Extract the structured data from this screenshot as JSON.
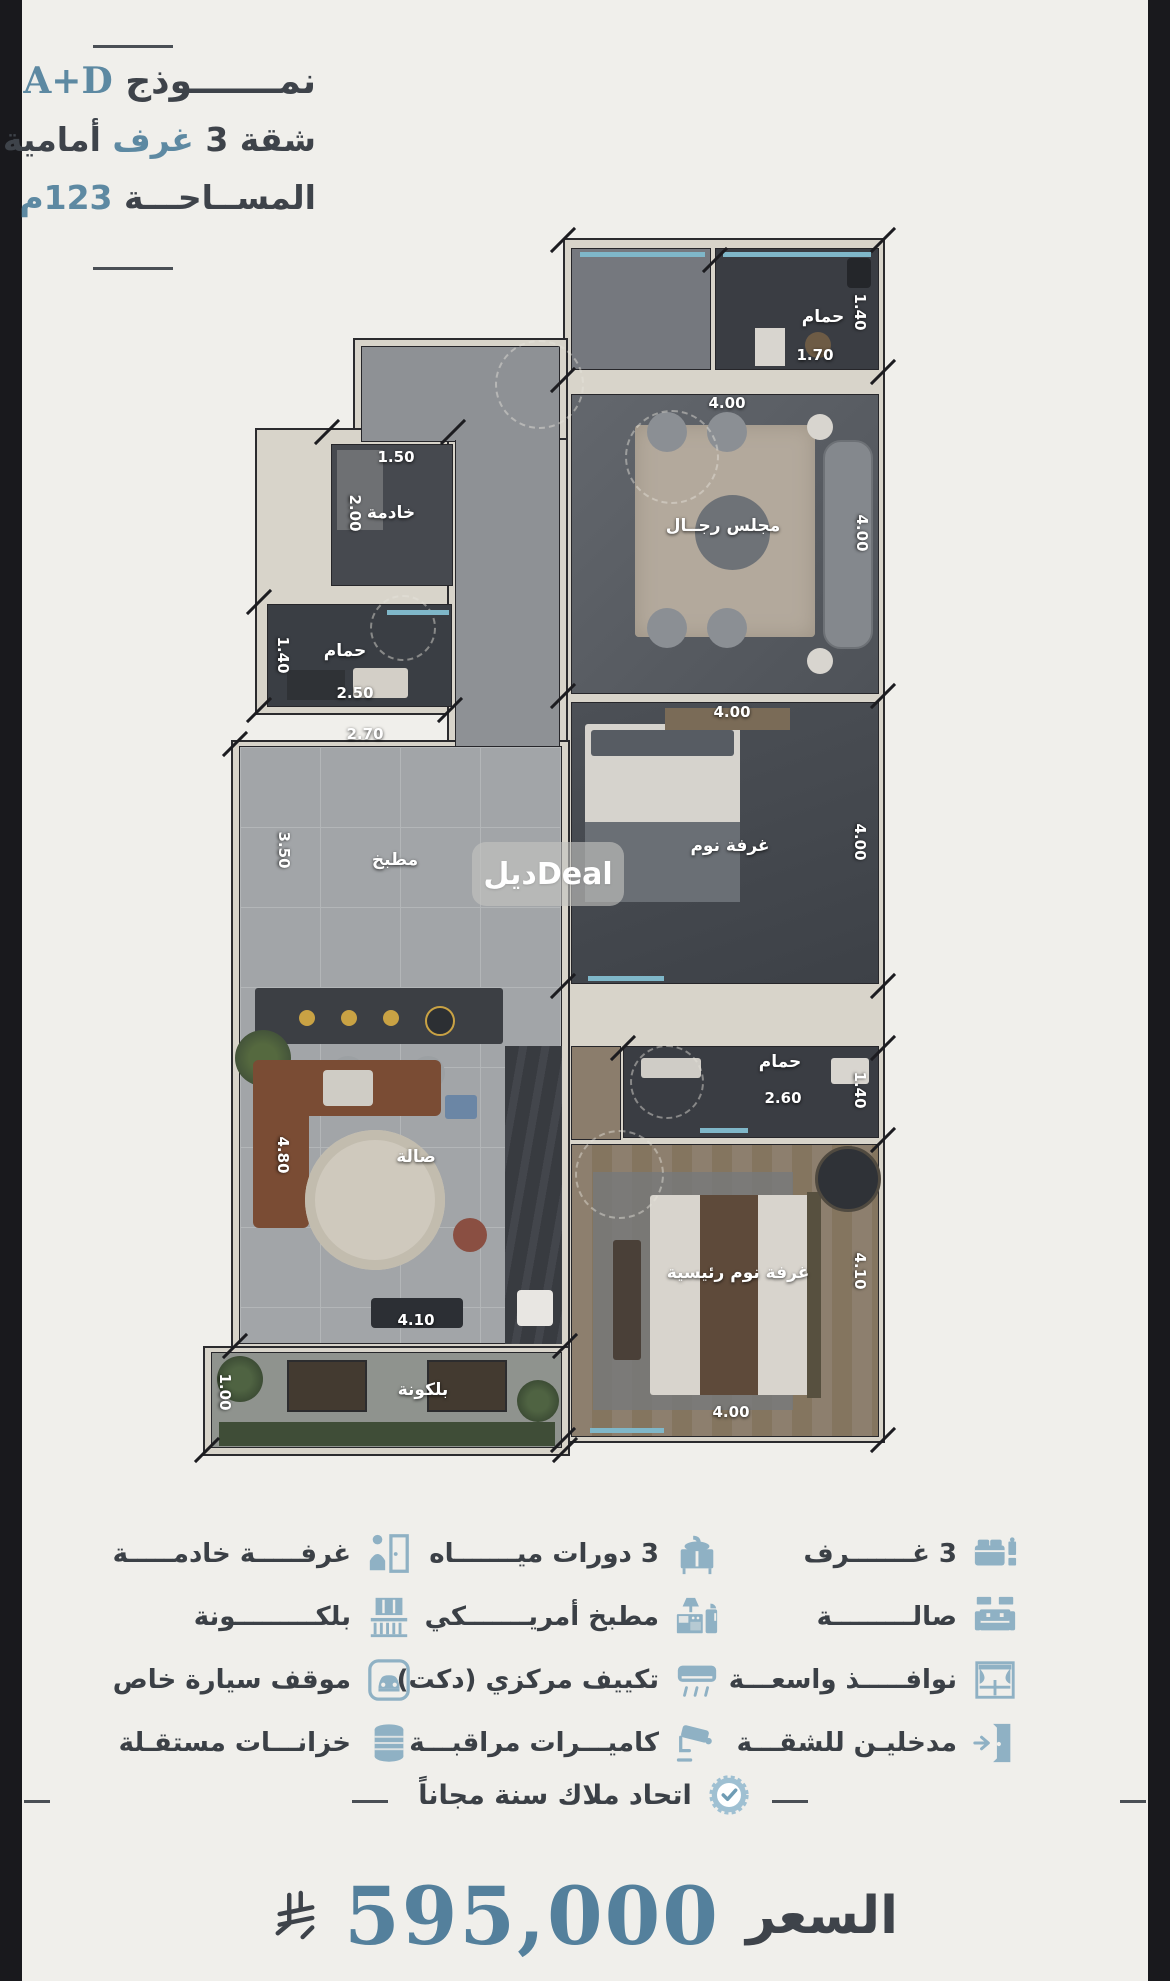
{
  "page": {
    "bg": "#f0efeb",
    "edge_strip_color": "#19191d",
    "accent_blue": "#5d89a2",
    "text_dark": "#3b4046",
    "icon_blue": "#8fb1c4"
  },
  "title": {
    "l1_ar": "نمـــــــوذج",
    "l1_code": "A+D",
    "l2_a": "شقة 3 ",
    "l2_b": "غرف",
    "l2_c": " أمامية",
    "l3_a": "المســاحـــة ",
    "l3_b": "123م"
  },
  "plan": {
    "watermark": "ديلDeal",
    "rooms": {
      "top_bath": {
        "name": "حمام",
        "w": "1.70",
        "h": "1.40"
      },
      "majlis": {
        "name": "مجلس رجــال",
        "w": "4.00",
        "h": "4.00"
      },
      "bedroom": {
        "name": "غرفة نوم",
        "w": "4.00",
        "h": "4.00"
      },
      "mid_bath": {
        "name": "حمام",
        "w": "2.60",
        "h": "1.40"
      },
      "master": {
        "name": "غرفة نوم رئيسية",
        "w": "4.00",
        "h": "4.10"
      },
      "maid": {
        "name": "خادمة",
        "w": "1.50",
        "h": "2.00"
      },
      "left_bath": {
        "name": "حمام",
        "w": "2.50",
        "h": "1.40"
      },
      "kitchen": {
        "name": "مطبخ",
        "w": "2.70",
        "h": "3.50"
      },
      "hall": {
        "name": "صالة",
        "w": "4.10",
        "h": "4.80"
      },
      "balcony": {
        "name": "بلكونة",
        "h": "1.00"
      }
    }
  },
  "features": {
    "col_right": [
      {
        "icon": "bed-icon",
        "label": "3 غـــــــرف"
      },
      {
        "icon": "sofa-icon",
        "label": "صالـــــــــة"
      },
      {
        "icon": "window-icon",
        "label": "نوافـــــذ واسعـــة"
      },
      {
        "icon": "door-entry-icon",
        "label": "مدخليـن للشقـــة"
      }
    ],
    "col_middle": [
      {
        "icon": "sink-icon",
        "label": "3 دورات ميـــــــاه"
      },
      {
        "icon": "kitchen-icon",
        "label": "مطبخ أمريـــــــكي"
      },
      {
        "icon": "ac-icon",
        "label": "تكييف مركزي (دكت)"
      },
      {
        "icon": "camera-icon",
        "label": "كاميـــرات مراقبـــة"
      }
    ],
    "col_left": [
      {
        "icon": "maid-room-icon",
        "label": "غرفـــــة خادمـــــة"
      },
      {
        "icon": "balcony-icon",
        "label": "بلكـــــــــونة"
      },
      {
        "icon": "car-icon",
        "label": "موقف سيارة خاص"
      },
      {
        "icon": "tanks-icon",
        "label": "خزانـــات مستقـلة"
      }
    ]
  },
  "badge": {
    "icon": "check-rosette-icon",
    "label": "اتحاد ملاك سنة مجاناً"
  },
  "price": {
    "label": "السعر",
    "value": "595,000",
    "currency_icon": "saudi-riyal-symbol"
  }
}
